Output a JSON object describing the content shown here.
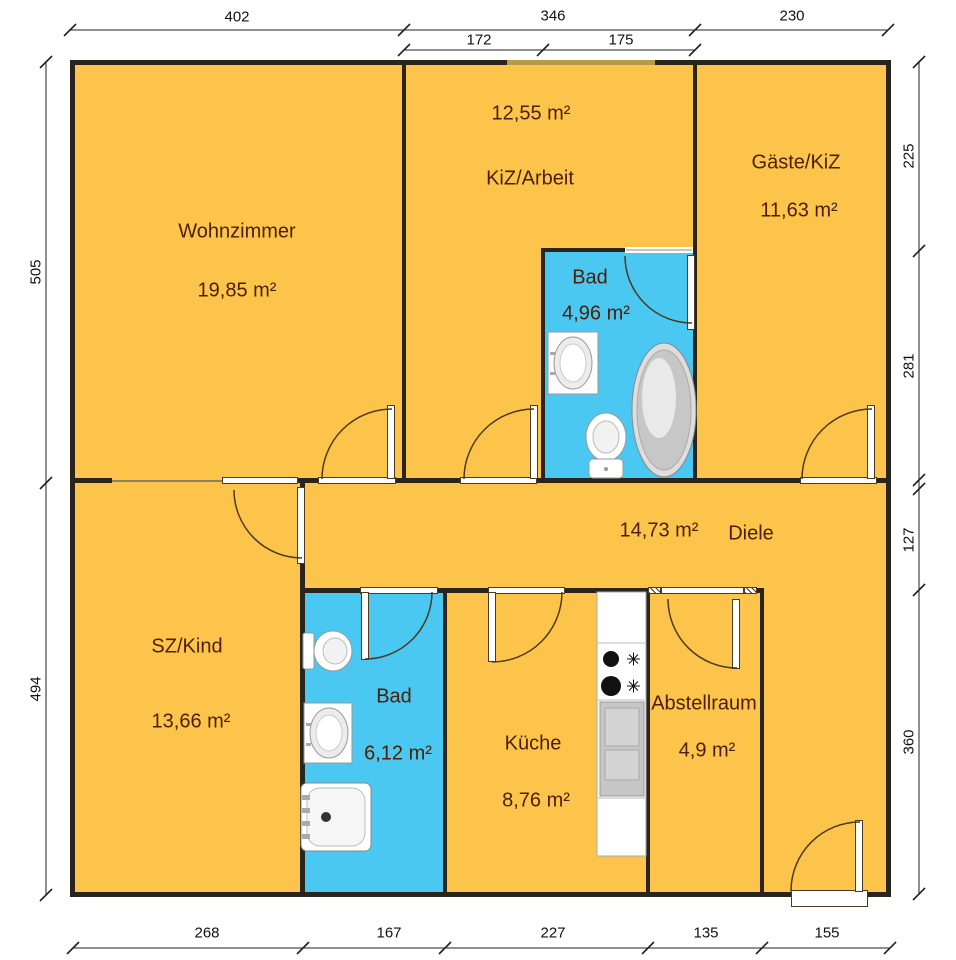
{
  "rooms": [
    {
      "name": "Wohnzimmer",
      "area": "19,85 m²"
    },
    {
      "name": "KiZ/Arbeit",
      "area": "12,55 m²"
    },
    {
      "name": "Gäste/KiZ",
      "area": "11,63 m²"
    },
    {
      "name": "Bad",
      "area": "4,96 m²"
    },
    {
      "name": "Diele",
      "area": "14,73 m²"
    },
    {
      "name": "SZ/Kind",
      "area": "13,66 m²"
    },
    {
      "name": "Bad",
      "area": "6,12 m²"
    },
    {
      "name": "Küche",
      "area": "8,76 m²"
    },
    {
      "name": "Abstellraum",
      "area": "4,9 m²"
    }
  ],
  "dimensions": {
    "top": [
      {
        "label": "402"
      },
      {
        "label": "346"
      },
      {
        "label": "230"
      }
    ],
    "top_sub": [
      {
        "label": "172"
      },
      {
        "label": "175"
      }
    ],
    "left": [
      {
        "label": "505"
      },
      {
        "label": "494"
      }
    ],
    "right": [
      {
        "label": "225"
      },
      {
        "label": "281"
      },
      {
        "label": "127"
      },
      {
        "label": "360"
      }
    ],
    "bottom": [
      {
        "label": "268"
      },
      {
        "label": "167"
      },
      {
        "label": "227"
      },
      {
        "label": "135"
      },
      {
        "label": "155"
      }
    ]
  },
  "colors": {
    "room_fill": "#FDC44C",
    "bath_fill": "#4BC8F2",
    "wall": "#2A241C",
    "label_text": "#4A1F05",
    "dimension_text": "#111111"
  }
}
